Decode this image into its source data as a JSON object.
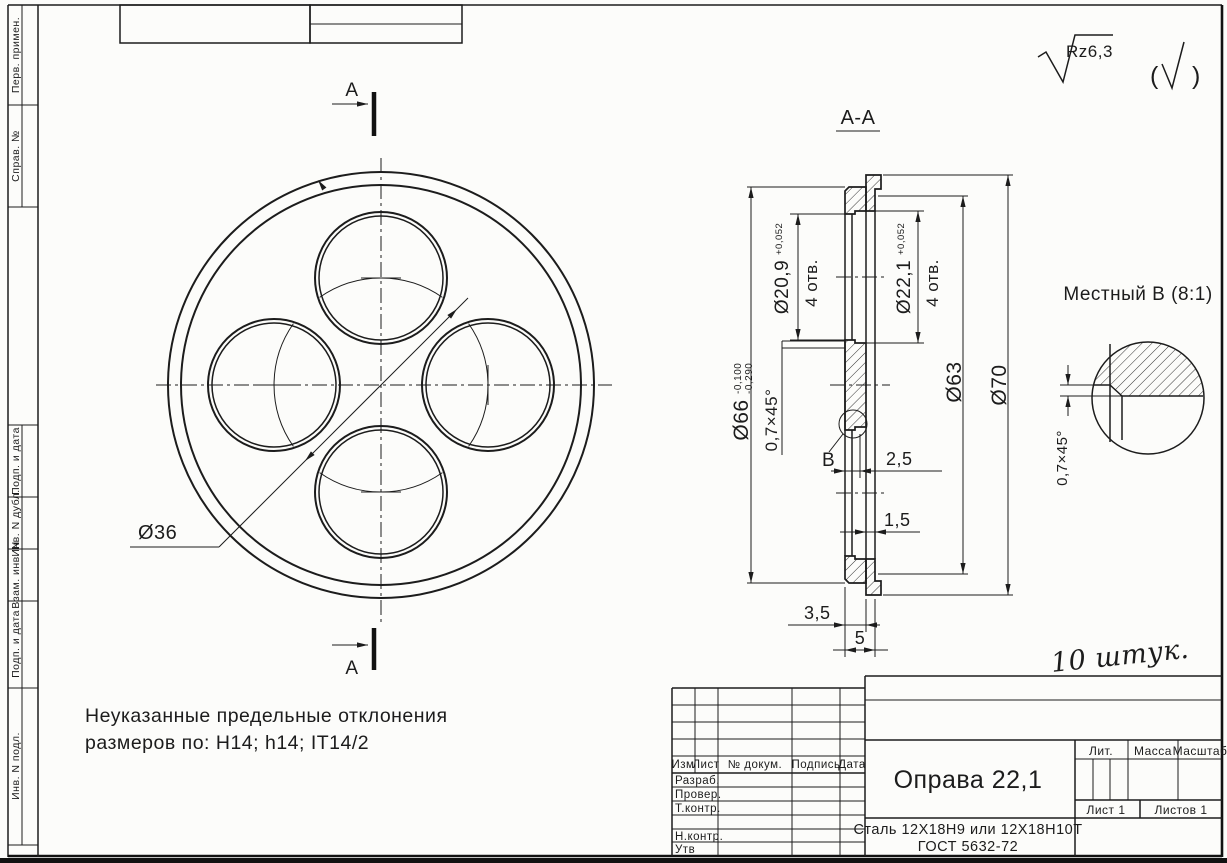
{
  "stamp_left": {
    "cells": [
      {
        "label": "Перв. примен."
      },
      {
        "label": "Справ. №"
      },
      {
        "label": "Подп. и дата"
      },
      {
        "label": "Инв. N дубл."
      },
      {
        "label": "Взам. инв. N"
      },
      {
        "label": "Подп. и дата"
      },
      {
        "label": "Инв. N подл."
      }
    ]
  },
  "roughness": {
    "value": "Rz6,3",
    "paren_open": "(",
    "paren_close": ")"
  },
  "views": {
    "section_label": "А-А",
    "cut_mark_top": "А",
    "cut_mark_bottom": "А",
    "detail_title": "Местный В (8:1)",
    "detail_chamfer": "0,7×45°"
  },
  "dims": {
    "bolt_circle": "Ø36",
    "d66": "Ø66",
    "d66_tol_upper": "-0,100",
    "d66_tol_lower": "-0,290",
    "d209": "Ø20,9",
    "d209_tol": "+0,052",
    "d209_note": "4 отв.",
    "d221": "Ø22,1",
    "d221_tol": "+0,052",
    "d221_note": "4 отв.",
    "d63": "Ø63",
    "d70": "Ø70",
    "chamfer": "0,7×45°",
    "web": "2,5",
    "rim": "1,5",
    "step": "3,5",
    "thickness": "5",
    "detail_ref": "В"
  },
  "note": {
    "line1": "Неуказанные предельные отклонения",
    "line2": "размеров по: H14; h14; IT14/2"
  },
  "annotation": {
    "quantity": "10 штук."
  },
  "title_block": {
    "columns": {
      "izm": "Изм",
      "list": "Лист",
      "doc": "№ докум.",
      "sign": "Подпись",
      "date": "Дата"
    },
    "rows": {
      "razrab": "Разраб.",
      "prover": "Провер.",
      "tkontr": "Т.контр.",
      "nkontr": "Н.контр.",
      "utv": "Утв"
    },
    "part_name": "Оправа 22,1",
    "material_line1": "Сталь 12Х18Н9 или 12Х18Н10Т",
    "material_line2": "ГОСТ 5632-72",
    "lit": "Лит.",
    "mass": "Масса",
    "scale": "Масштаб",
    "sheet": "Лист 1",
    "sheets": "Листов 1"
  }
}
